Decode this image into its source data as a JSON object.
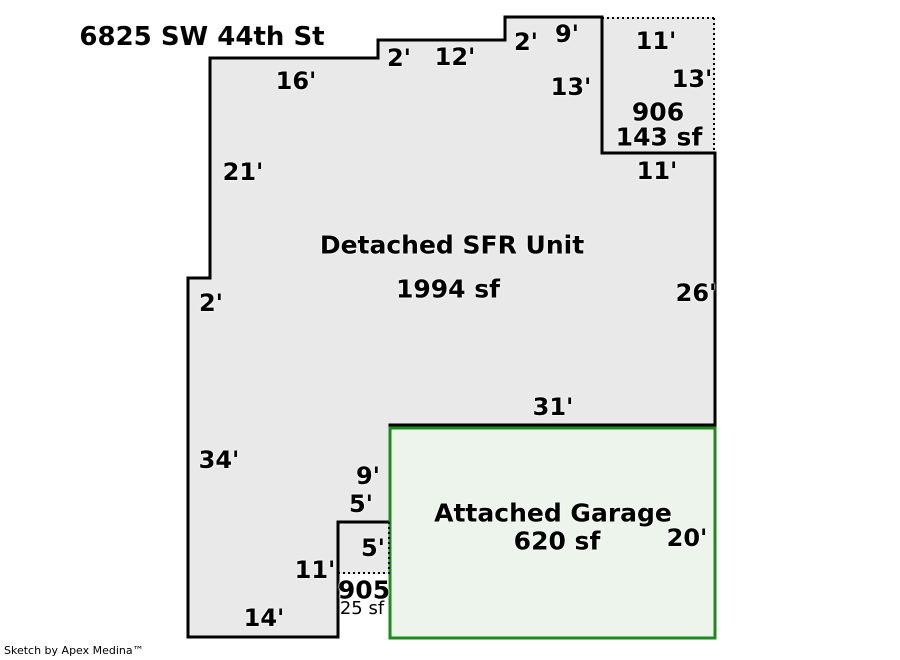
{
  "title": "6825 SW 44th St",
  "credit": "Sketch by Apex Medina™",
  "unit": {
    "name": "Detached SFR Unit",
    "area": "1994 sf"
  },
  "garage": {
    "name": "Attached Garage",
    "area": "620 sf"
  },
  "porch906": {
    "number": "906",
    "area": "143 sf"
  },
  "patio905": {
    "number": "905",
    "area": "25 sf"
  },
  "colors": {
    "unit_fill": "#e9e9e9",
    "unit_outline": "#000000",
    "garage_fill": "#ecf4ec",
    "garage_border": "#1e8a1e",
    "background": "#ffffff"
  },
  "dimensions": [
    {
      "side": "top-west",
      "label": "16'"
    },
    {
      "side": "top-step-1",
      "label": "2'"
    },
    {
      "side": "top-middle",
      "label": "12'"
    },
    {
      "side": "top-step-2",
      "label": "2'"
    },
    {
      "side": "top-east",
      "label": "9'"
    },
    {
      "side": "porch-top",
      "label": "11'"
    },
    {
      "side": "porch-west-wall",
      "label": "13'"
    },
    {
      "side": "porch-east",
      "label": "13'"
    },
    {
      "side": "porch-bottom-wall",
      "label": "11'"
    },
    {
      "side": "west-upper",
      "label": "21'"
    },
    {
      "side": "west-notch",
      "label": "2'"
    },
    {
      "side": "east-wall",
      "label": "26'"
    },
    {
      "side": "garage-top-wall",
      "label": "31'"
    },
    {
      "side": "west-lower",
      "label": "34'"
    },
    {
      "side": "jog-vertical",
      "label": "9'"
    },
    {
      "side": "jog-horizontal",
      "label": "5'"
    },
    {
      "side": "patio-side",
      "label": "5'"
    },
    {
      "side": "southwest-wall",
      "label": "11'"
    },
    {
      "side": "bottom-wall",
      "label": "14'"
    },
    {
      "side": "garage-east-wall",
      "label": "20'"
    }
  ]
}
